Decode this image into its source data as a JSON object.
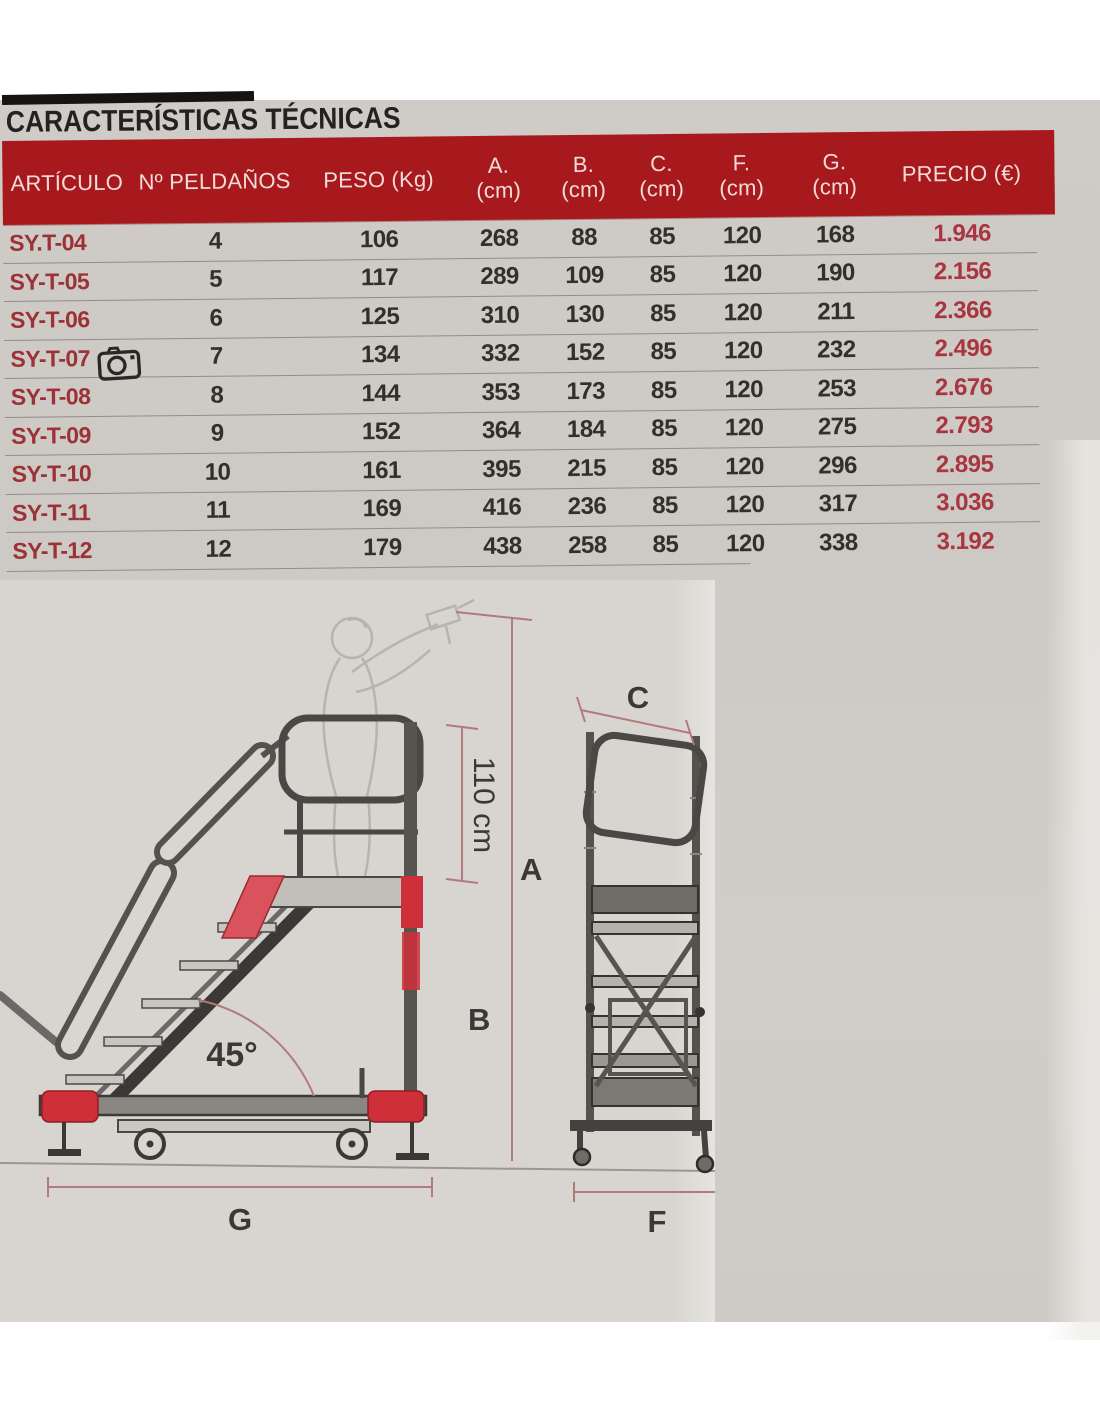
{
  "page": {
    "title": "CARACTERÍSTICAS TÉCNICAS"
  },
  "colors": {
    "header_bg": "#a8191d",
    "header_text": "#f2dcd9",
    "article_red": "#9c3136",
    "price_red": "#a93540",
    "accent_red": "#cf2f38",
    "dimension_line": "#b27a7a"
  },
  "icons": {
    "camera": "camera-icon"
  },
  "table": {
    "headers": [
      {
        "t": "ARTÍCULO"
      },
      {
        "t": "Nº PELDAÑOS"
      },
      {
        "t": "PESO (Kg)"
      },
      {
        "t": "A.",
        "s": "(cm)"
      },
      {
        "t": "B.",
        "s": "(cm)"
      },
      {
        "t": "C.",
        "s": "(cm)"
      },
      {
        "t": "F.",
        "s": "(cm)"
      },
      {
        "t": "G.",
        "s": "(cm)"
      },
      {
        "t": "PRECIO (€)"
      }
    ],
    "rows": [
      {
        "art": "SY.T-04",
        "n": "4",
        "peso": "106",
        "a": "268",
        "b": "88",
        "c": "85",
        "f": "120",
        "g": "168",
        "precio": "1.946"
      },
      {
        "art": "SY-T-05",
        "n": "5",
        "peso": "117",
        "a": "289",
        "b": "109",
        "c": "85",
        "f": "120",
        "g": "190",
        "precio": "2.156"
      },
      {
        "art": "SY-T-06",
        "n": "6",
        "peso": "125",
        "a": "310",
        "b": "130",
        "c": "85",
        "f": "120",
        "g": "211",
        "precio": "2.366"
      },
      {
        "art": "SY-T-07",
        "n": "7",
        "peso": "134",
        "a": "332",
        "b": "152",
        "c": "85",
        "f": "120",
        "g": "232",
        "precio": "2.496"
      },
      {
        "art": "SY-T-08",
        "n": "8",
        "peso": "144",
        "a": "353",
        "b": "173",
        "c": "85",
        "f": "120",
        "g": "253",
        "precio": "2.676"
      },
      {
        "art": "SY-T-09",
        "n": "9",
        "peso": "152",
        "a": "364",
        "b": "184",
        "c": "85",
        "f": "120",
        "g": "275",
        "precio": "2.793"
      },
      {
        "art": "SY-T-10",
        "n": "10",
        "peso": "161",
        "a": "395",
        "b": "215",
        "c": "85",
        "f": "120",
        "g": "296",
        "precio": "2.895"
      },
      {
        "art": "SY-T-11",
        "n": "11",
        "peso": "169",
        "a": "416",
        "b": "236",
        "c": "85",
        "f": "120",
        "g": "317",
        "precio": "3.036"
      },
      {
        "art": "SY-T-12",
        "n": "12",
        "peso": "179",
        "a": "438",
        "b": "258",
        "c": "85",
        "f": "120",
        "g": "338",
        "precio": "3.192"
      }
    ]
  },
  "diagram": {
    "labels": {
      "dim_a": "A",
      "dim_b": "B",
      "dim_c": "C",
      "dim_f": "F",
      "dim_g": "G",
      "height": "110 cm",
      "angle": "45°"
    }
  }
}
